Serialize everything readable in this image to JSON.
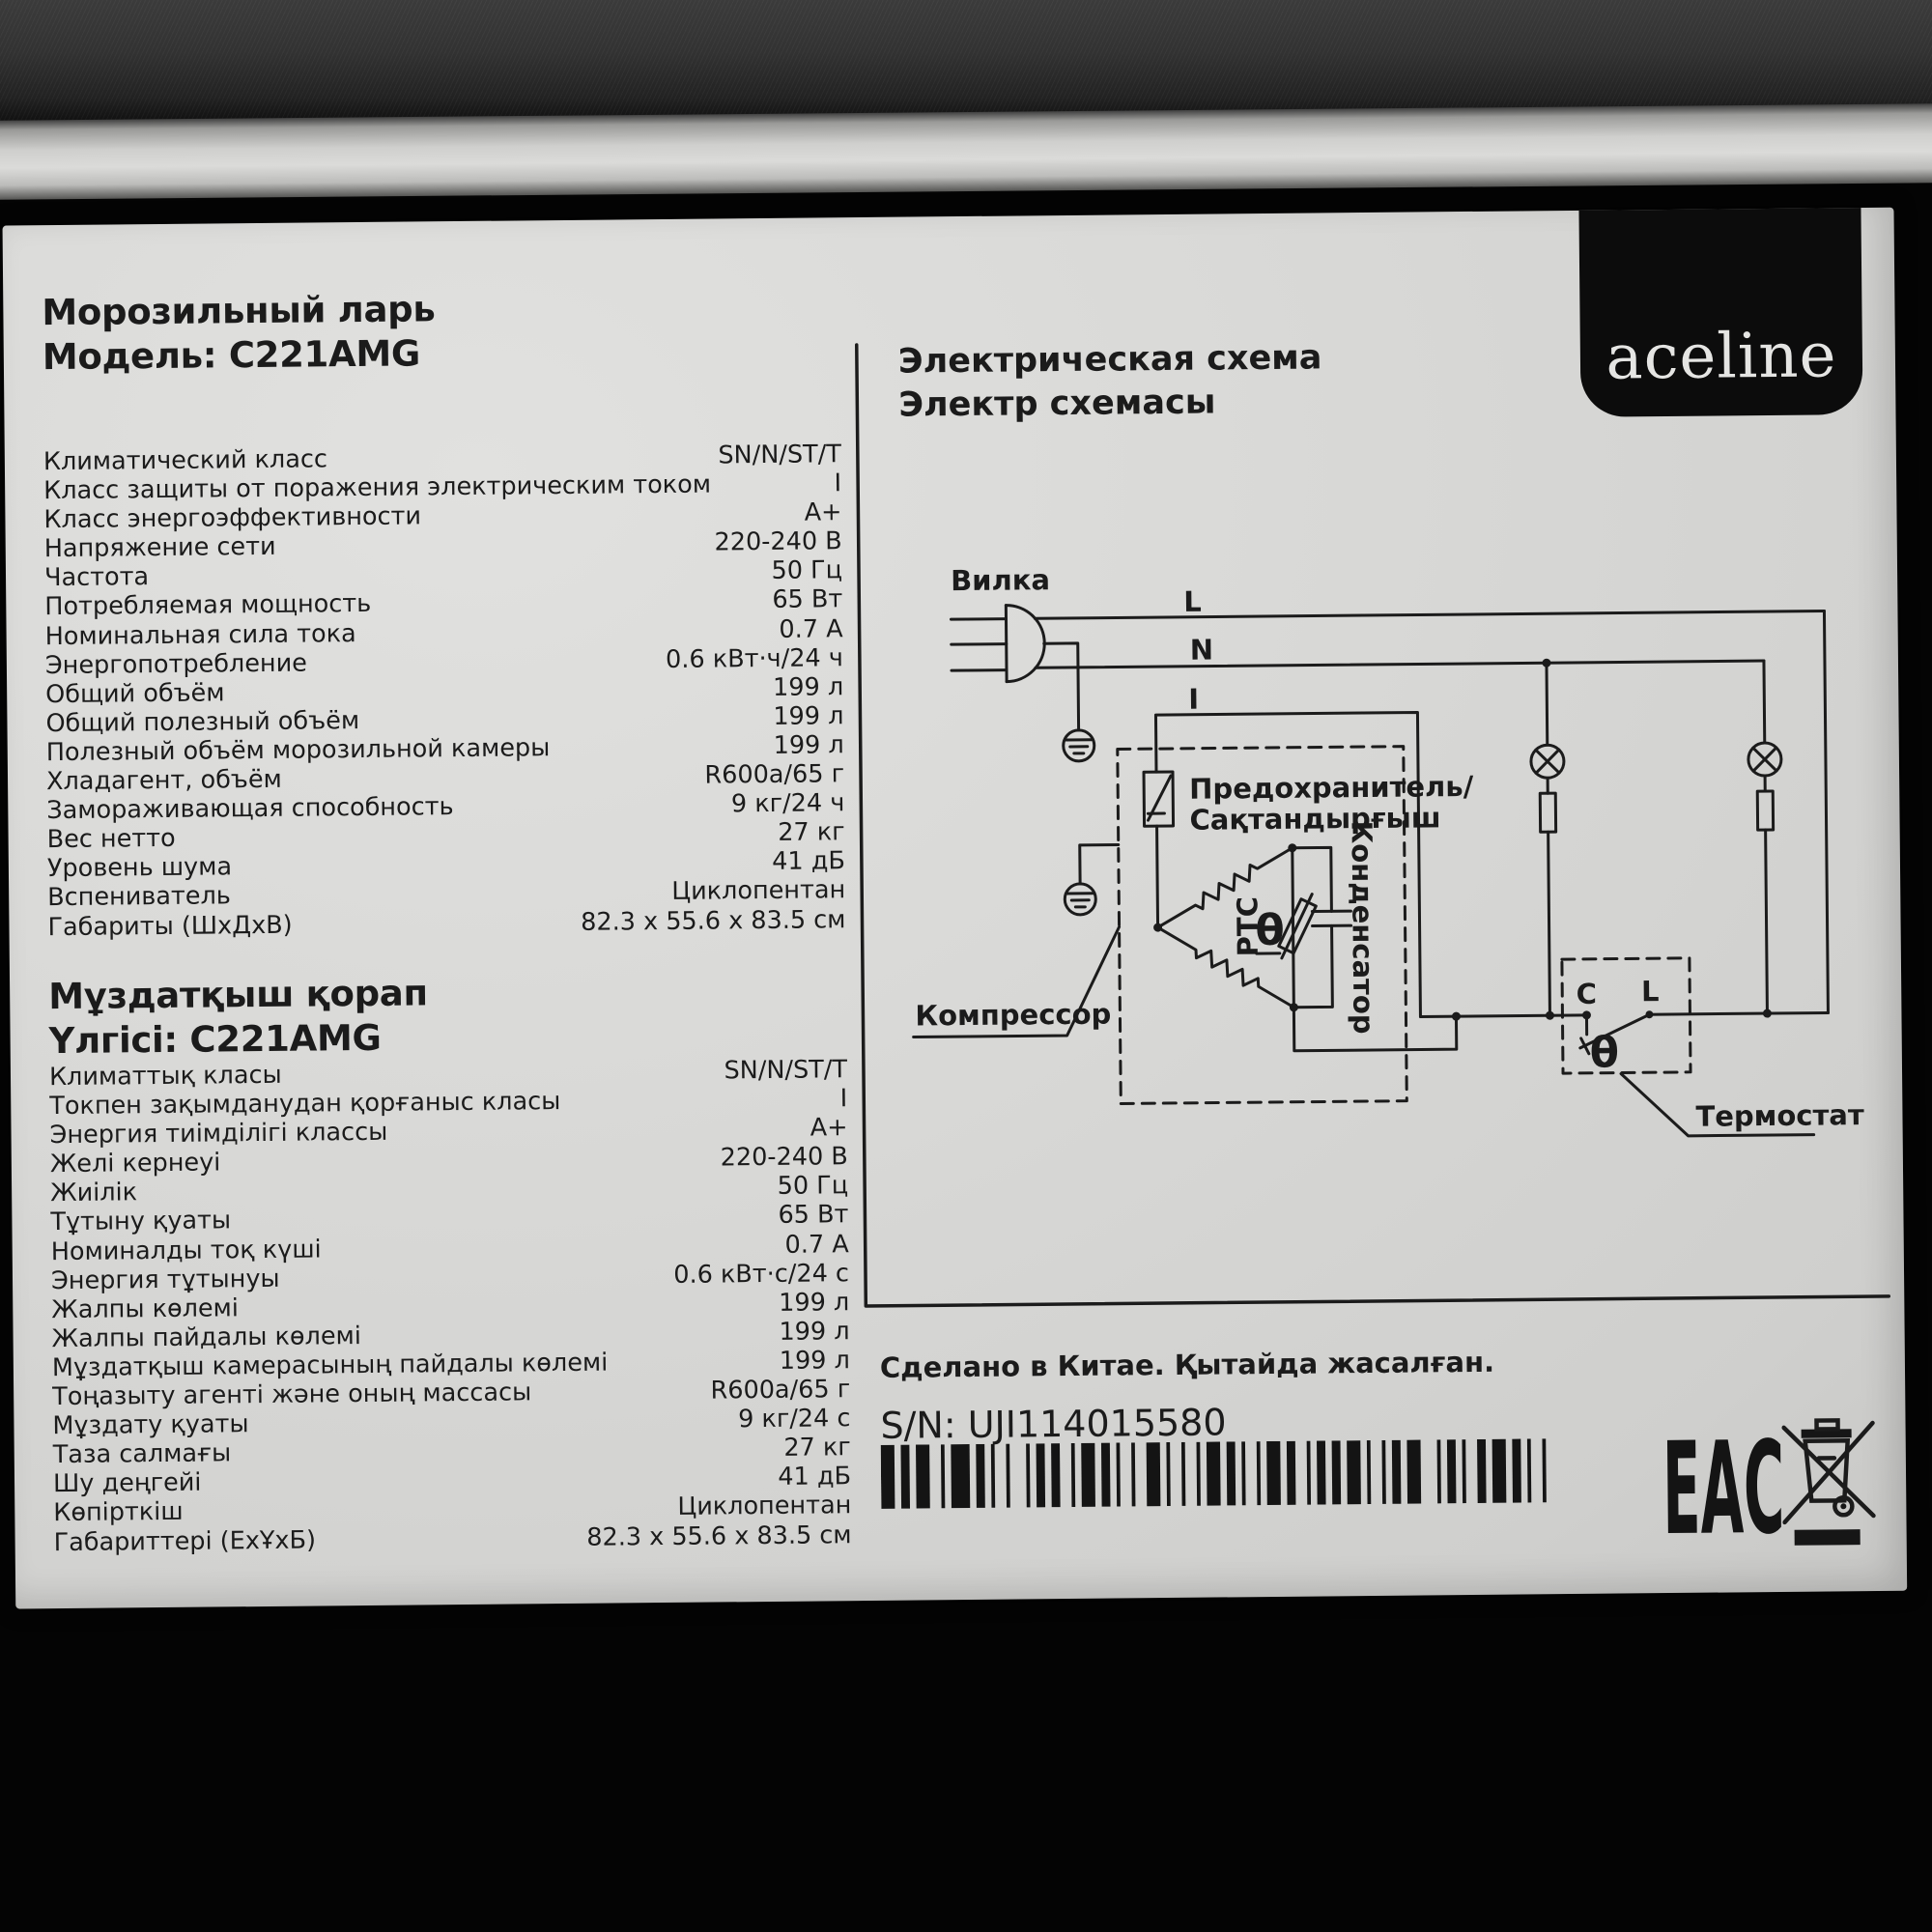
{
  "colors": {
    "ink": "#1b1b1b",
    "label_bg": "#d8d8d6"
  },
  "label": {
    "brand": "aceline",
    "ru": {
      "title_line1": "Морозильный ларь",
      "title_line2": "Модель: C221AMG",
      "rows": [
        {
          "label": "Климатический класс",
          "value": "SN/N/ST/T"
        },
        {
          "label": "Класс защиты от поражения электрическим током",
          "value": "I"
        },
        {
          "label": "Класс энергоэффективности",
          "value": "A+"
        },
        {
          "label": "Напряжение сети",
          "value": "220-240 В"
        },
        {
          "label": "Частота",
          "value": "50 Гц"
        },
        {
          "label": "Потребляемая мощность",
          "value": "65 Вт"
        },
        {
          "label": "Номинальная сила тока",
          "value": "0.7 А"
        },
        {
          "label": "Энергопотребление",
          "value": "0.6 кВт·ч/24 ч"
        },
        {
          "label": "Общий объём",
          "value": "199 л"
        },
        {
          "label": "Общий полезный объём",
          "value": "199 л"
        },
        {
          "label": "Полезный объём морозильной камеры",
          "value": "199 л"
        },
        {
          "label": "Хладагент, объём",
          "value": "R600a/65 г"
        },
        {
          "label": "Замораживающая способность",
          "value": "9 кг/24 ч"
        },
        {
          "label": "Вес нетто",
          "value": "27 кг"
        },
        {
          "label": "Уровень шума",
          "value": "41 дБ"
        },
        {
          "label": "Вспениватель",
          "value": "Циклопентан"
        },
        {
          "label": "Габариты (ШхДхВ)",
          "value": "82.3 x 55.6 x 83.5 см"
        }
      ]
    },
    "kz": {
      "title_line1": "Мұздатқыш қорап",
      "title_line2": "Үлгісі: C221AMG",
      "rows": [
        {
          "label": "Климаттық класы",
          "value": "SN/N/ST/T"
        },
        {
          "label": "Токпен зақымданудан қорғаныс класы",
          "value": "I"
        },
        {
          "label": "Энергия тиімділігі классы",
          "value": "A+"
        },
        {
          "label": "Желі кернеуі",
          "value": "220-240 В"
        },
        {
          "label": "Жиілік",
          "value": "50 Гц"
        },
        {
          "label": "Тұтыну қуаты",
          "value": "65 Вт"
        },
        {
          "label": "Номиналды тоқ күші",
          "value": "0.7 А"
        },
        {
          "label": "Энергия тұтынуы",
          "value": "0.6 кВт·с/24 с"
        },
        {
          "label": "Жалпы көлемі",
          "value": "199 л"
        },
        {
          "label": "Жалпы пайдалы көлемі",
          "value": "199 л"
        },
        {
          "label": "Мұздатқыш камерасының пайдалы көлемі",
          "value": "199 л"
        },
        {
          "label": "Тоңазыту агенті және оның массасы",
          "value": "R600a/65 г"
        },
        {
          "label": "Мұздату қуаты",
          "value": "9 кг/24 с"
        },
        {
          "label": "Таза салмағы",
          "value": "27 кг"
        },
        {
          "label": "Шу деңгейі",
          "value": "41 дБ"
        },
        {
          "label": "Көпірткіш",
          "value": "Циклопентан"
        },
        {
          "label": "Габариттері (ЕхҰхБ)",
          "value": "82.3 x 55.6 x 83.5 см"
        }
      ]
    },
    "schematic": {
      "title_line1": "Электрическая схема",
      "title_line2": "Электр схемасы",
      "labels": {
        "plug": "Вилка",
        "line": "L",
        "neutral": "N",
        "i": "I",
        "fuse_ru": "Предохранитель/",
        "fuse_kz": "Сақтандырғыш",
        "ptc": "PTC",
        "theta_motor": "θ",
        "capacitor": "Конденсатор",
        "compressor": "Компрессор",
        "thermostat": "Термостат",
        "term_c": "C",
        "term_l": "L",
        "theta_thermostat": "θ"
      }
    },
    "footer": {
      "made_in": "Сделано в Китае. Қытайда жасалған.",
      "serial": "S/N: UJI114015580",
      "eac": "ЕАС",
      "barcode_pattern": "31213211412112131121221131211212311212113121121131221121213112112133112112213121121"
    }
  }
}
